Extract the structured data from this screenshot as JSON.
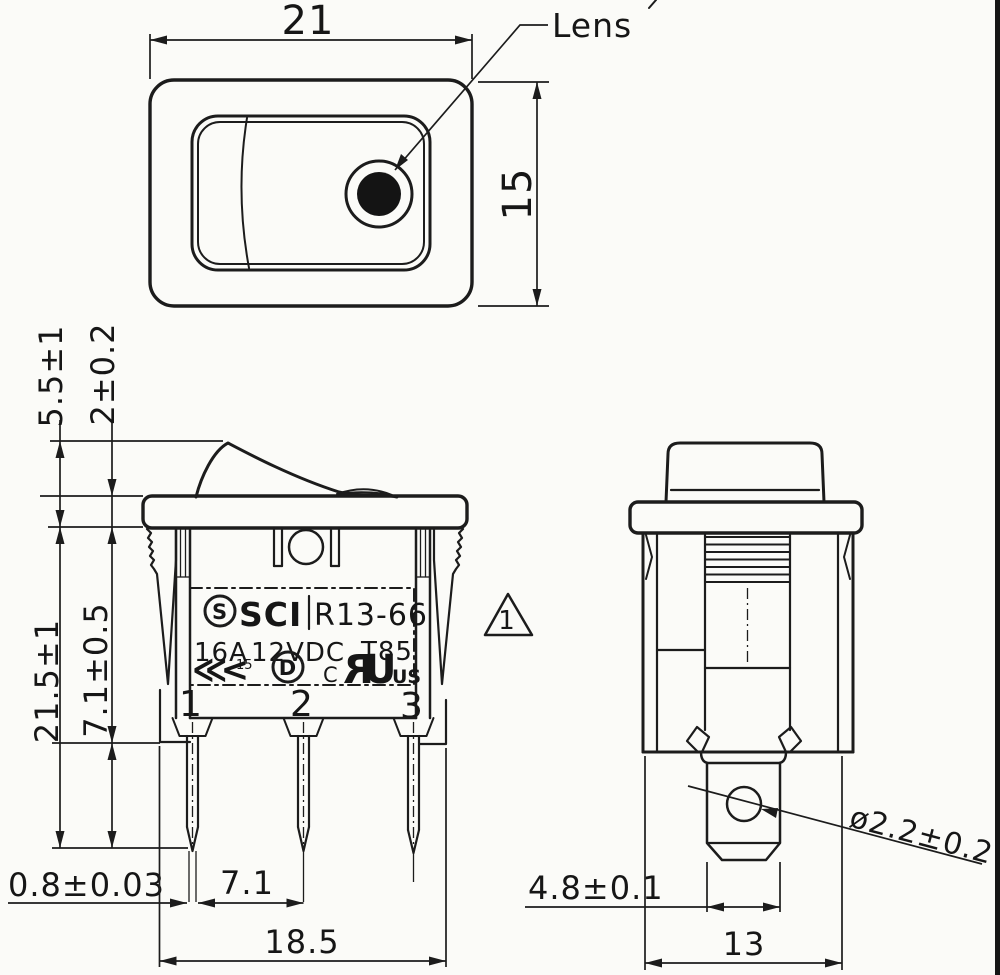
{
  "drawing": {
    "top_view": {
      "dim_width": "21",
      "dim_height": "15",
      "lens_label": "Lens"
    },
    "front_view": {
      "dim_actuator_height": "5.5±1",
      "dim_bezel_thickness": "2±0.2",
      "dim_total_height": "21.5±1",
      "dim_body_height": "7.1±0.5",
      "dim_terminal_thickness": "0.8±0.03",
      "dim_terminal_pitch": "7.1",
      "dim_base_width": "18.5",
      "terminals": [
        "1",
        "2",
        "3"
      ],
      "revision_marker": "1",
      "label_plate": {
        "logo_letter": "S",
        "brand": "SCI",
        "model": "R13-66",
        "current_rating": "16A",
        "voltage_rating": "12VDC",
        "temperature_rating": "T85",
        "chevron_mark": "≪<",
        "chevron_number": "15",
        "d_mark": "D",
        "ul_prefix": "C",
        "ul_letter_reversed": "R",
        "ul_letter": "U",
        "ul_suffix": "US"
      }
    },
    "side_view": {
      "dim_terminal_width": "4.8±0.1",
      "dim_depth": "13",
      "dim_hole_diameter": "ø2.2±0.2"
    }
  }
}
